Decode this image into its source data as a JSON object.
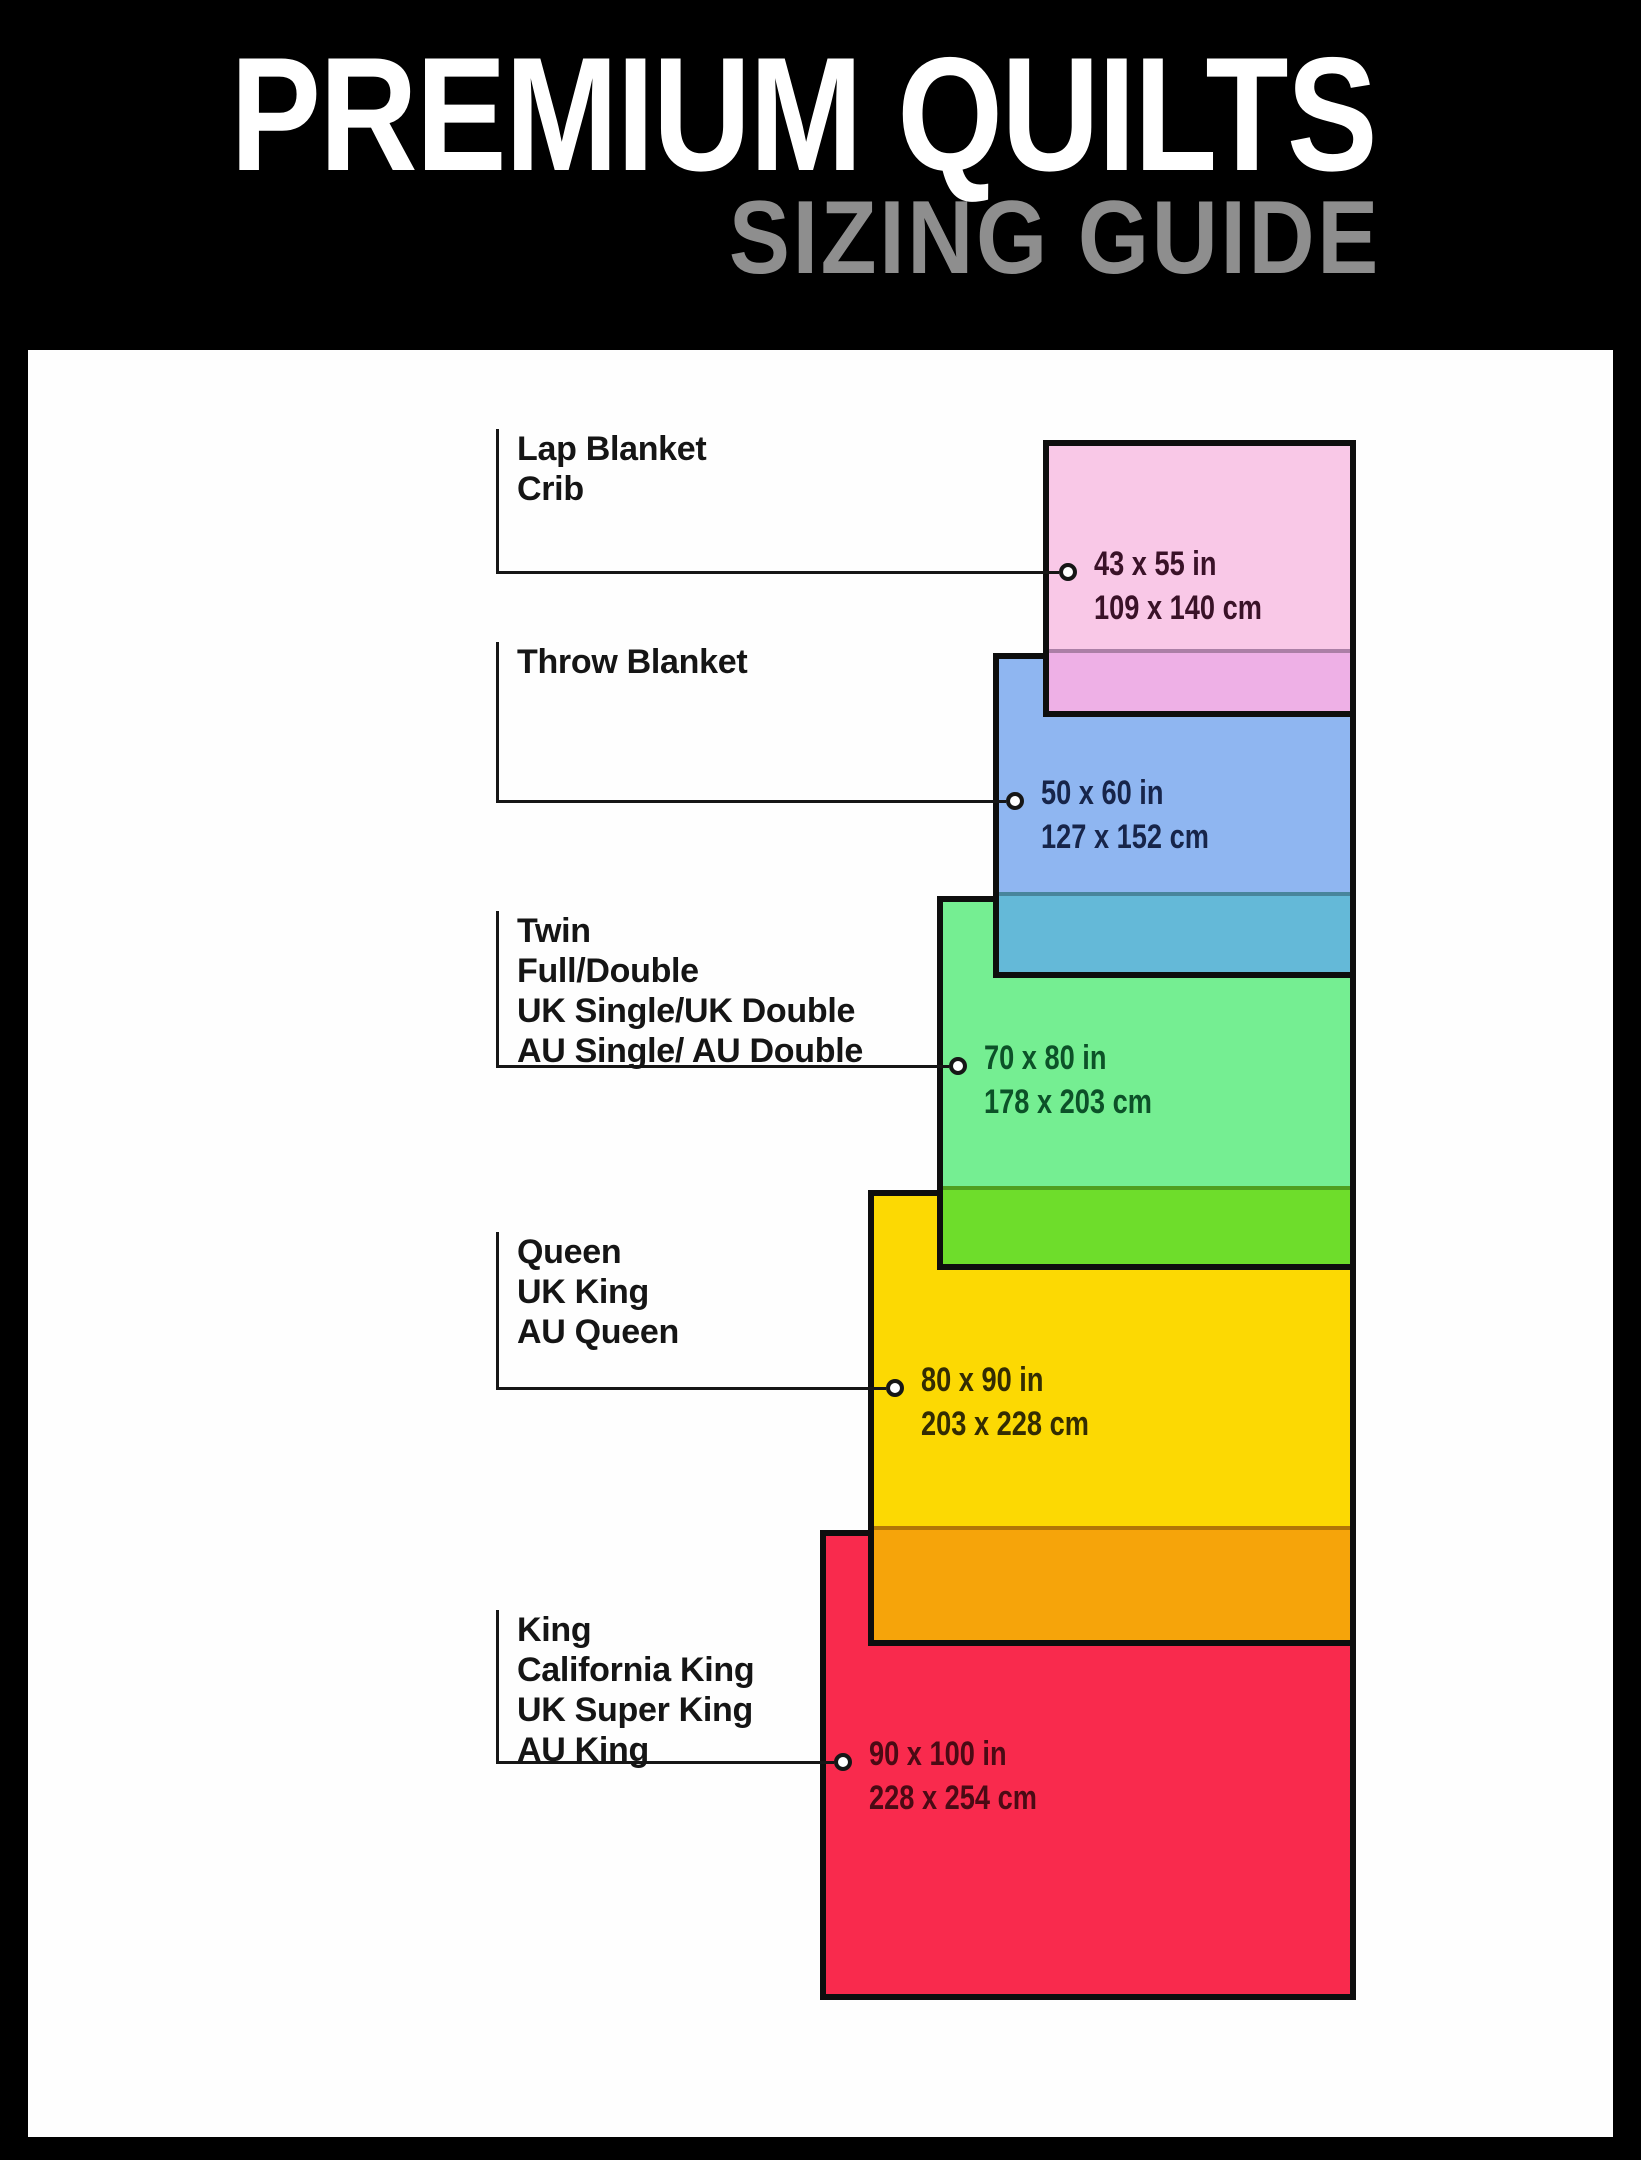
{
  "header": {
    "title": "PREMIUM QUILTS",
    "subtitle": "SIZING GUIDE"
  },
  "colors": {
    "frame": "#000000",
    "page": "#fefefe",
    "title": "#ffffff",
    "subtitle": "#8e8e8e",
    "label_text": "#151515",
    "line": "#161616",
    "border": "#0e0e0e"
  },
  "sizes": [
    {
      "labels": [
        "Lap Blanket",
        "Crib"
      ],
      "inches": "43 x 55 in",
      "cm": "109 x 140 cm",
      "fill": "#f9c8e7",
      "overlap_fill": "#eeb0e6",
      "text_color": "#3a1228"
    },
    {
      "labels": [
        "Throw Blanket"
      ],
      "inches": "50 x 60 in",
      "cm": "127 x 152 cm",
      "fill": "#8fb6f1",
      "overlap_fill": "#64b9d8",
      "text_color": "#17254a"
    },
    {
      "labels": [
        "Twin",
        "Full/Double",
        "UK Single/UK Double",
        "AU Single/ AU Double"
      ],
      "inches": "70 x 80 in",
      "cm": "178 x 203 cm",
      "fill": "#75ee92",
      "overlap_fill": "#6edd2b",
      "text_color": "#0c5128"
    },
    {
      "labels": [
        "Queen",
        "UK King",
        "AU Queen"
      ],
      "inches": "80 x 90 in",
      "cm": "203 x 228 cm",
      "fill": "#fcd903",
      "overlap_fill": "#f6a40a",
      "text_color": "#332c02"
    },
    {
      "labels": [
        "King",
        "California King",
        "UK Super King",
        "AU King"
      ],
      "inches": "90 x 100 in",
      "cm": "228 x 254 cm",
      "fill": "#f92a4d",
      "text_color": "#4a0a14"
    }
  ]
}
